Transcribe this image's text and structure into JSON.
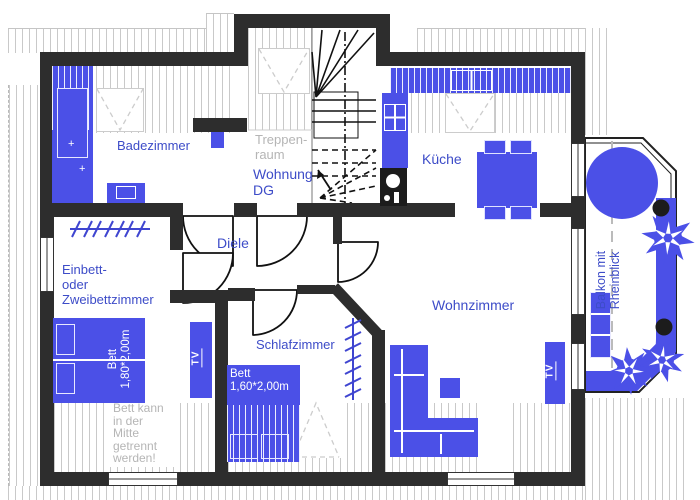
{
  "meta": {
    "drawing": "floor-plan",
    "floor_label": "Wohnung DG"
  },
  "colors": {
    "furniture_blue": "#4b50e7",
    "wall": "#2d2d2d",
    "label_blue": "#3d4cc8",
    "muted_gray": "#b5b5b5",
    "hatch_gray": "#c9c9c9"
  },
  "rooms": {
    "badezimmer": {
      "label": "Badezimmer"
    },
    "treppenraum": {
      "lines": [
        "Treppen-",
        "raum"
      ]
    },
    "wohnung": {
      "lines": [
        "Wohnung",
        "DG"
      ]
    },
    "kueche": {
      "label": "Küche"
    },
    "diele": {
      "label": "Diele"
    },
    "einbettzimmer": {
      "lines": [
        "Einbett-",
        "oder",
        "Zweibettzimmer"
      ]
    },
    "schlafzimmer": {
      "label": "Schlafzimmer"
    },
    "wohnzimmer": {
      "label": "Wohnzimmer"
    },
    "balkon": {
      "lines": [
        "Balkon mit",
        "Rheinblick"
      ]
    }
  },
  "furniture": {
    "bed_large": {
      "lines": [
        "Bett",
        "1,80*2,00m"
      ]
    },
    "bed_small": {
      "lines": [
        "Bett",
        "1,60*2,00m"
      ]
    },
    "bed_note": {
      "lines": [
        "Bett kann",
        "in der",
        "Mitte",
        "getrennt",
        "werden!"
      ]
    },
    "tv1": {
      "label": "TV"
    },
    "tv2": {
      "label": "TV"
    },
    "bath_cross1": "+",
    "bath_cross2": "+"
  }
}
